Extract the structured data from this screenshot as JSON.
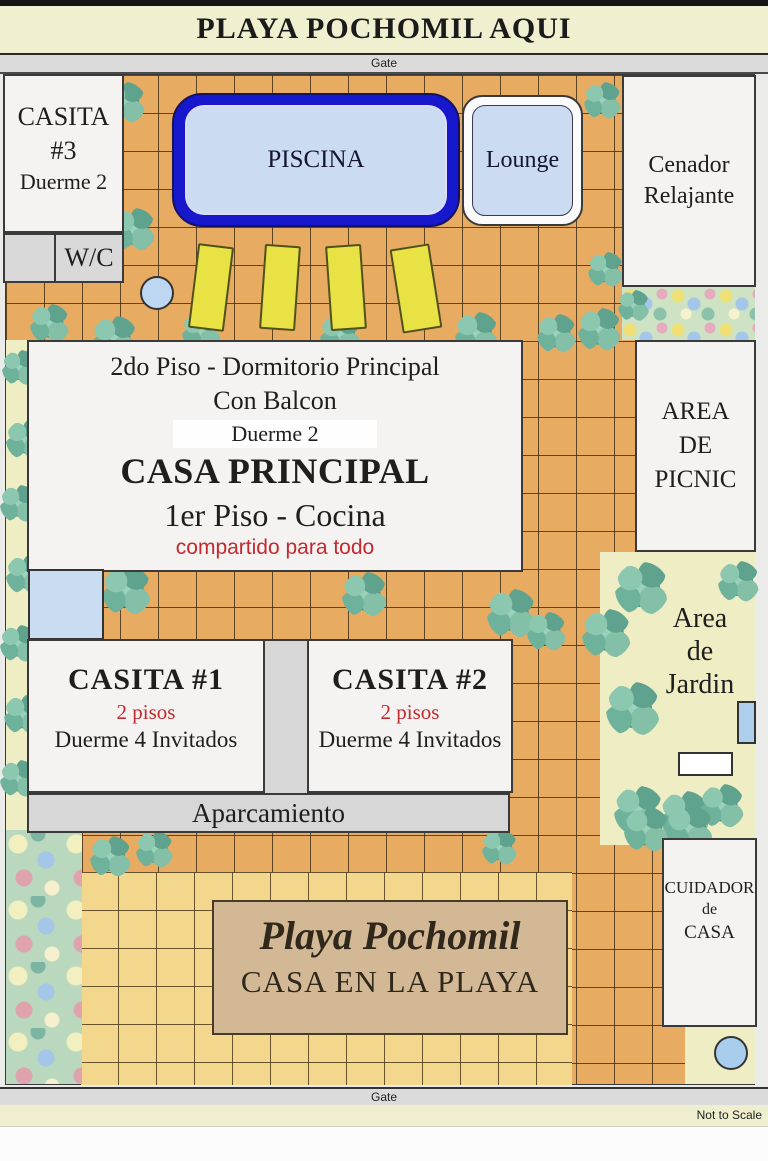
{
  "header": {
    "title": "PLAYA POCHOMIL AQUI"
  },
  "gates": {
    "top": "Gate",
    "bottom": "Gate"
  },
  "footer": {
    "scale_note": "Not to Scale"
  },
  "buildings": {
    "casita3": {
      "name": "CASITA",
      "number": "#3",
      "sleeps": "Duerme 2"
    },
    "wc": {
      "label": "W/C"
    },
    "piscina": {
      "label": "PISCINA"
    },
    "lounge": {
      "label": "Lounge"
    },
    "cenador": {
      "line1": "Cenador",
      "line2": "Relajante"
    },
    "casa_principal": {
      "floor2": "2do Piso - Dormitorio Principal",
      "balcony": "Con Balcon",
      "sleeps": "Duerme 2",
      "name": "CASA PRINCIPAL",
      "floor1": "1er Piso - Cocina",
      "shared": "compartido para todo"
    },
    "picnic": {
      "line1": "AREA",
      "line2": "DE",
      "line3": "PICNIC"
    },
    "jardin": {
      "line1": "Area",
      "line2": "de",
      "line3": "Jardin"
    },
    "casita1": {
      "name": "CASITA #1",
      "floors": "2 pisos",
      "sleeps": "Duerme 4 Invitados"
    },
    "casita2": {
      "name": "CASITA #2",
      "floors": "2 pisos",
      "sleeps": "Duerme 4 Invitados"
    },
    "aparcamiento": {
      "label": "Aparcamiento"
    },
    "cuidador": {
      "line1": "CUIDADOR",
      "line2": "de",
      "line3": "CASA"
    },
    "sign": {
      "line1": "Playa Pochomil",
      "line2": "CASA EN LA PLAYA"
    }
  },
  "colors": {
    "tile_orange": "#E8AB62",
    "tile_sand": "#F3D78D",
    "pool_blue": "#1717CE",
    "water_light": "#CBDCF2",
    "chair_yellow": "#E9E244",
    "accent_red": "#C22A30",
    "sign_tan": "#D3B896",
    "banner_cream": "#F0EFCF",
    "garden_green": "#B9D8BE"
  }
}
